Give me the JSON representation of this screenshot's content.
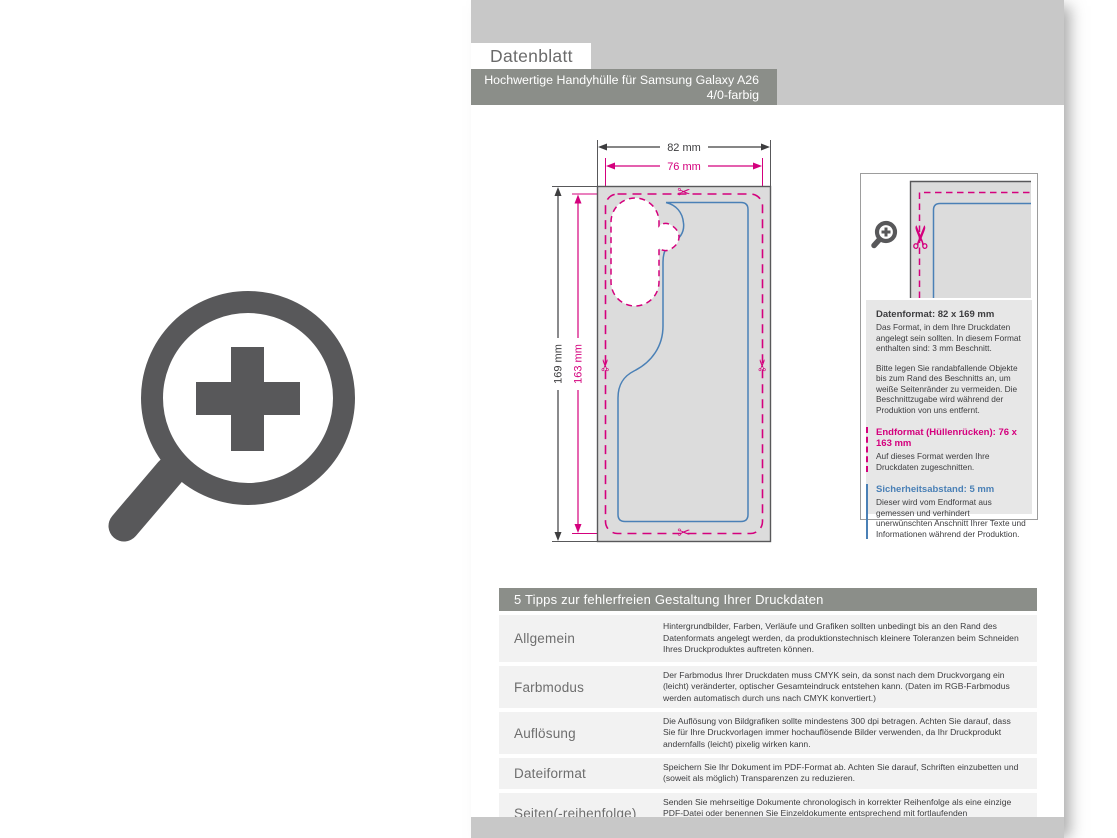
{
  "header": {
    "sheet_label": "Datenblatt",
    "product_title": "Hochwertige Handyhülle für Samsung Galaxy A26",
    "color_variant": "4/0-farbig"
  },
  "diagram": {
    "width_outer": "82 mm",
    "width_inner": "76 mm",
    "height_outer": "169 mm",
    "height_inner": "163 mm"
  },
  "info_panel": {
    "datenformat": {
      "title": "Datenformat: 82 x 169 mm",
      "body": "Das Format, in dem Ihre Druckdaten angelegt sein sollten. In diesem Format enthalten sind: 3 mm Beschnitt."
    },
    "beschnitt_note": "Bitte legen Sie randabfallende Objekte bis zum Rand des Beschnitts an, um weiße Seitenränder zu vermeiden. Die Beschnittzugabe wird während der Produktion von uns entfernt.",
    "endformat": {
      "title": "Endformat (Hüllenrücken): 76 x 163 mm",
      "body": "Auf dieses Format werden Ihre Druckdaten zugeschnitten."
    },
    "sicherheitsabstand": {
      "title": "Sicherheitsabstand: 5 mm",
      "body": "Dieser wird vom Endformat aus gemessen und verhindert unerwünschten Anschnitt Ihrer Texte und Informationen während der Produktion."
    }
  },
  "tips_table": {
    "title": "5 Tipps zur fehlerfreien Gestaltung Ihrer Druckdaten",
    "rows": [
      {
        "label": "Allgemein",
        "text": "Hintergrundbilder, Farben, Verläufe und Grafiken sollten unbedingt bis an den Rand des Datenformats angelegt werden, da produktionstechnisch kleinere Toleranzen beim Schneiden Ihres Druckproduktes auftreten können."
      },
      {
        "label": "Farbmodus",
        "text": "Der Farbmodus Ihrer Druckdaten muss CMYK sein, da sonst nach dem Druckvorgang ein (leicht) veränderter, optischer Gesamteindruck entstehen kann. (Daten im RGB-Farbmodus werden automatisch durch uns nach CMYK konvertiert.)"
      },
      {
        "label": "Auflösung",
        "text": "Die Auflösung von Bildgrafiken sollte mindestens 300 dpi betragen. Achten Sie darauf, dass Sie für Ihre Druckvorlagen immer hochauflösende Bilder verwenden, da Ihr Druckprodukt andernfalls (leicht) pixelig wirken kann."
      },
      {
        "label": "Dateiformat",
        "text": "Speichern Sie Ihr Dokument im PDF-Format ab. Achten Sie darauf, Schriften einzubetten und (soweit als möglich) Transparenzen zu reduzieren."
      },
      {
        "label": "Seiten(-reihenfolge)",
        "text": "Senden Sie mehrseitige Dokumente chronologisch in korrekter Reihenfolge als eine einzige PDF-Datei oder benennen Sie Einzeldokumente entsprechend mit fortlaufenden Seitennummern."
      }
    ]
  },
  "icons": {
    "scissors_glyph": "✂",
    "magnifier": "zoom-plus-icon"
  },
  "colors": {
    "magenta_bleed": "#d4007d",
    "blue_safety": "#4a80b6",
    "dark_gray": "#58585a",
    "silver_band": "#c8c8c8",
    "bar_gray": "#8b8e89"
  }
}
